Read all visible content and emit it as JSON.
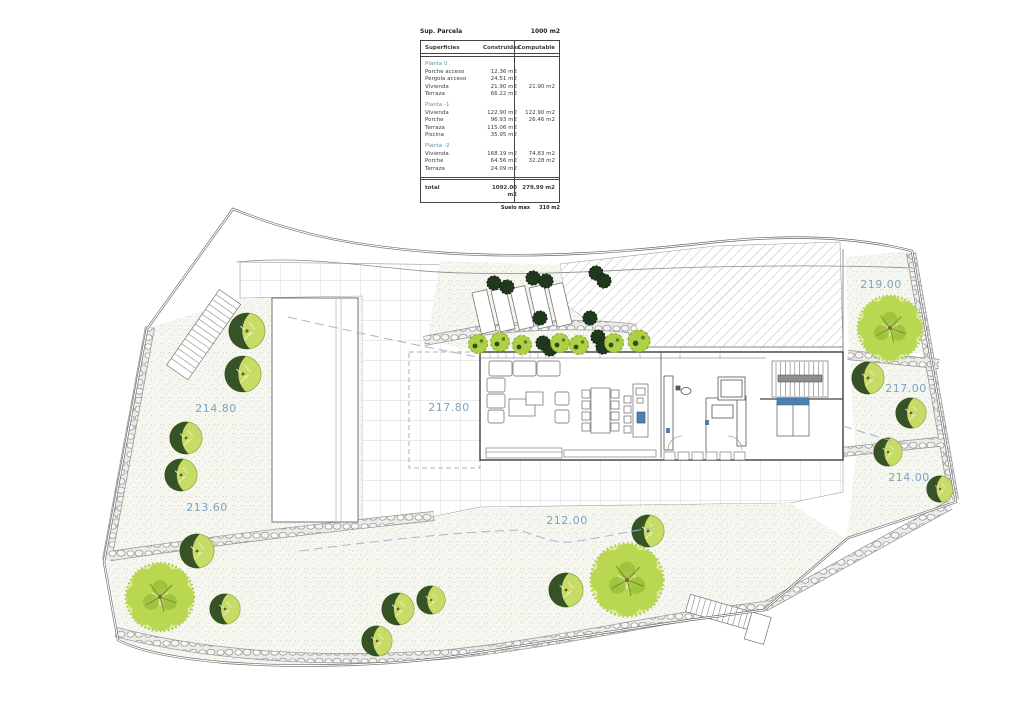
{
  "table": {
    "parcel_label": "Sup. Parcela",
    "parcel_value": "1000 m2",
    "headers": {
      "surfaces": "Superficies",
      "built": "Construidas",
      "computable": "Computable"
    },
    "sections": [
      {
        "name": "Planta 0",
        "rows": [
          {
            "label": "Porche acceso",
            "built": "12.36 m2",
            "computable": ""
          },
          {
            "label": "Pergola acceso",
            "built": "24.51 m2",
            "computable": ""
          },
          {
            "label": "Vivienda",
            "built": "21.90 m2",
            "computable": "21.90 m2"
          },
          {
            "label": "Terraza",
            "built": "66.22 m2",
            "computable": ""
          }
        ]
      },
      {
        "name": "Planta -1",
        "rows": [
          {
            "label": "Vivienda",
            "built": "122.90 m2",
            "computable": "122.90 m2"
          },
          {
            "label": "Porche",
            "built": "96.93 m2",
            "computable": "26.46 m2"
          },
          {
            "label": "Terraza",
            "built": "115.06 m2",
            "computable": ""
          },
          {
            "label": "Piscina",
            "built": "35.95 m2",
            "computable": ""
          }
        ]
      },
      {
        "name": "Planta -2",
        "rows": [
          {
            "label": "Vivienda",
            "built": "168.19 m2",
            "computable": "74.83 m2"
          },
          {
            "label": "Porche",
            "built": "64.56 m2",
            "computable": "32.28 m2"
          },
          {
            "label": "Terraza",
            "built": "24.09 m2",
            "computable": ""
          }
        ]
      }
    ],
    "total": {
      "label": "total",
      "built": "1092.00 m2",
      "computable": "279.99 m2"
    },
    "footnote": {
      "label": "Suelo max",
      "value": "310 m2"
    }
  },
  "plan": {
    "levels": [
      {
        "label": "214.80"
      },
      {
        "label": "217.80"
      },
      {
        "label": "213.60"
      },
      {
        "label": "212.00"
      },
      {
        "label": "219.00"
      },
      {
        "label": "217.00"
      },
      {
        "label": "214.00"
      }
    ],
    "colors": {
      "level_label": "#7ba3c4",
      "tree_light": "#c6dc66",
      "tree_dark": "#27431f",
      "bush_dark": "#20381c",
      "shrub": "#aed044",
      "water": "#4f7fae"
    }
  }
}
